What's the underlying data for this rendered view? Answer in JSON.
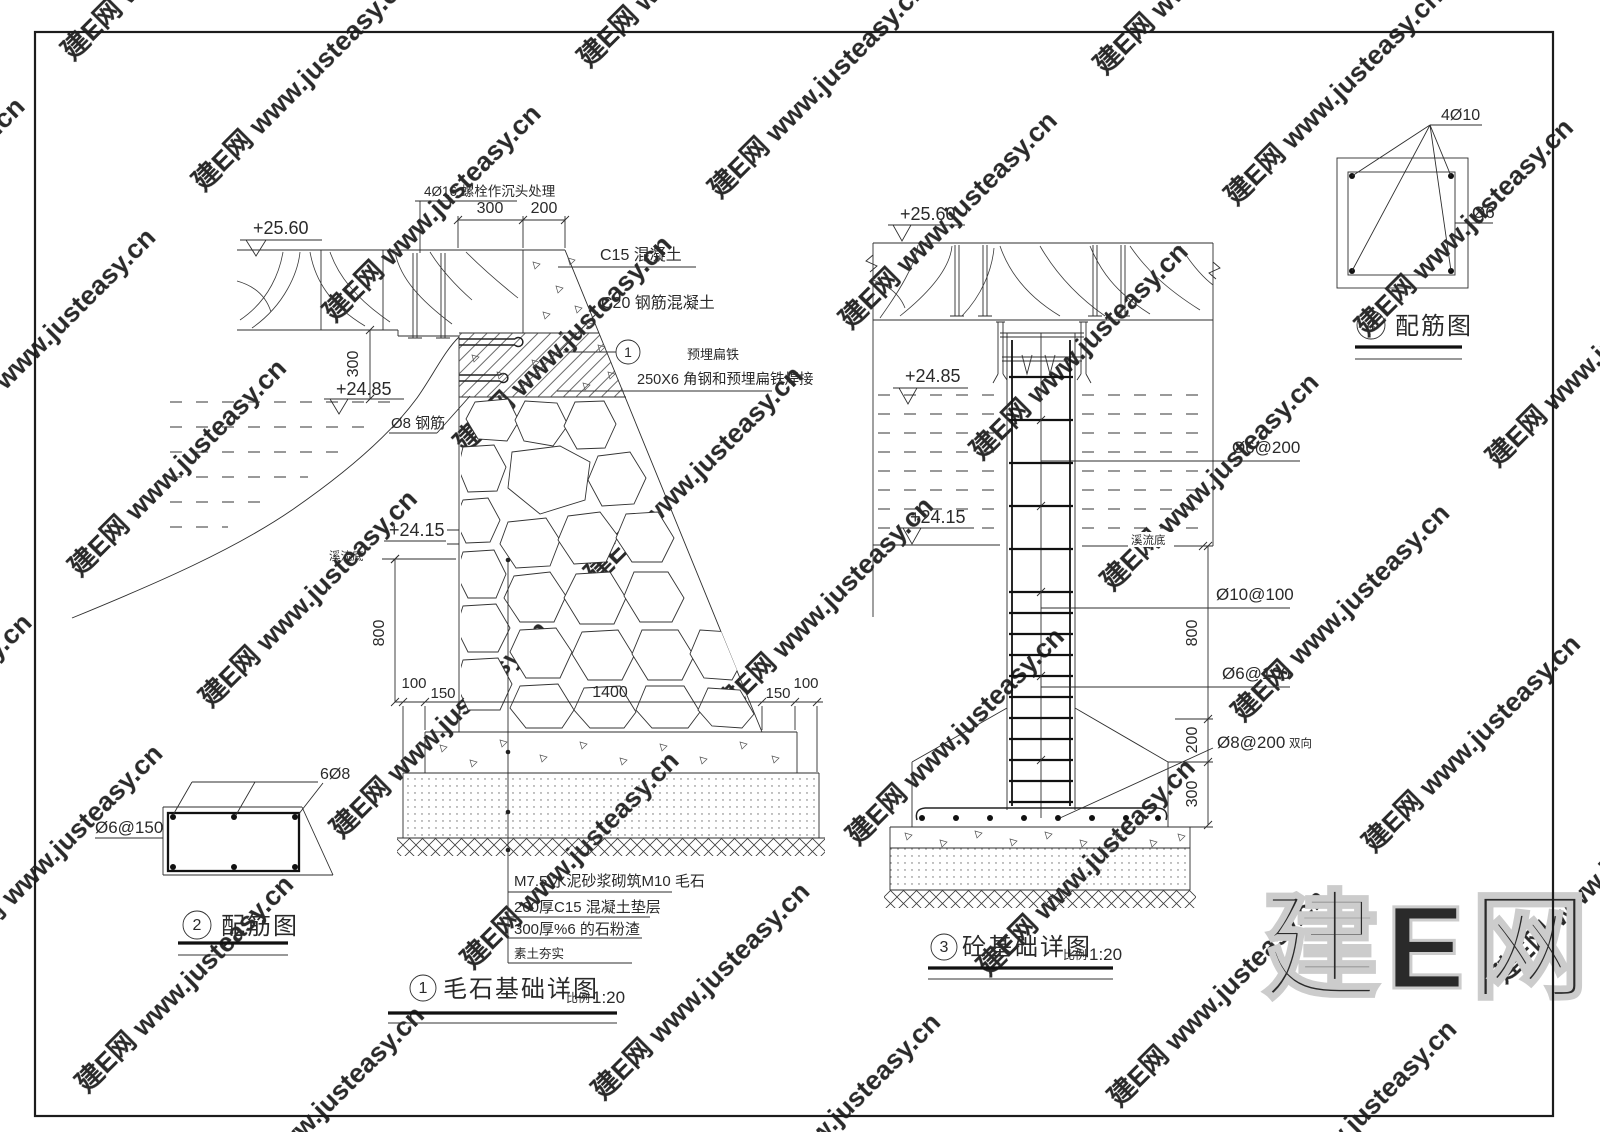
{
  "watermark": {
    "tile": "建E网 www.justeasy.cn",
    "big": "建E网"
  },
  "detail1": {
    "badge": "1",
    "title": "毛石基础详图",
    "scale_label": "比例",
    "scale": "1:20",
    "elev_top": "+25.60",
    "elev_mid": "+24.85",
    "elev_low": "+24.15",
    "stream_bottom": "溪流底",
    "label_bolt": "4Ø16 螺栓作沉头处理",
    "label_c15": "C15 混凝土",
    "label_c20": "C20 钢筋混凝土",
    "callout_no": "1",
    "label_embed": "预埋扁铁",
    "label_angle": "250X6 角钢和预埋扁铁焊接",
    "label_rebar": "Ø8 钢筋",
    "dim_300_top": "300",
    "dim_200_top": "200",
    "dim_300_v": "300",
    "dim_800": "800",
    "dim_100_l": "100",
    "dim_150_l": "150",
    "dim_1400": "1400",
    "dim_150_r": "150",
    "dim_100_r": "100",
    "notes": [
      "M7.5 水泥砂浆砌筑M10 毛石",
      "200厚C15 混凝土垫层",
      "300厚%6 的石粉渣",
      "素土夯实"
    ]
  },
  "detail2": {
    "badge": "2",
    "title": "配筋图",
    "label_top": "6Ø8",
    "label_left": "Ø6@150"
  },
  "detail3": {
    "badge": "3",
    "title": "砼基础详图",
    "scale_label": "比例",
    "scale": "1:20",
    "elev_top": "+25.60",
    "elev_mid": "+24.85",
    "elev_low": "+24.15",
    "stream_bottom": "溪流底",
    "label_stirrup200": "Ø6@200",
    "label_vert100": "Ø10@100",
    "label_stirrup100": "Ø6@100",
    "label_mat": "Ø8@200",
    "label_mat_suffix": "双向",
    "dim_800": "800",
    "dim_200": "200",
    "dim_300": "300"
  },
  "detail4": {
    "badge": "4",
    "title": "配筋图",
    "label_top": "4Ø10",
    "label_right": "Ø6"
  }
}
